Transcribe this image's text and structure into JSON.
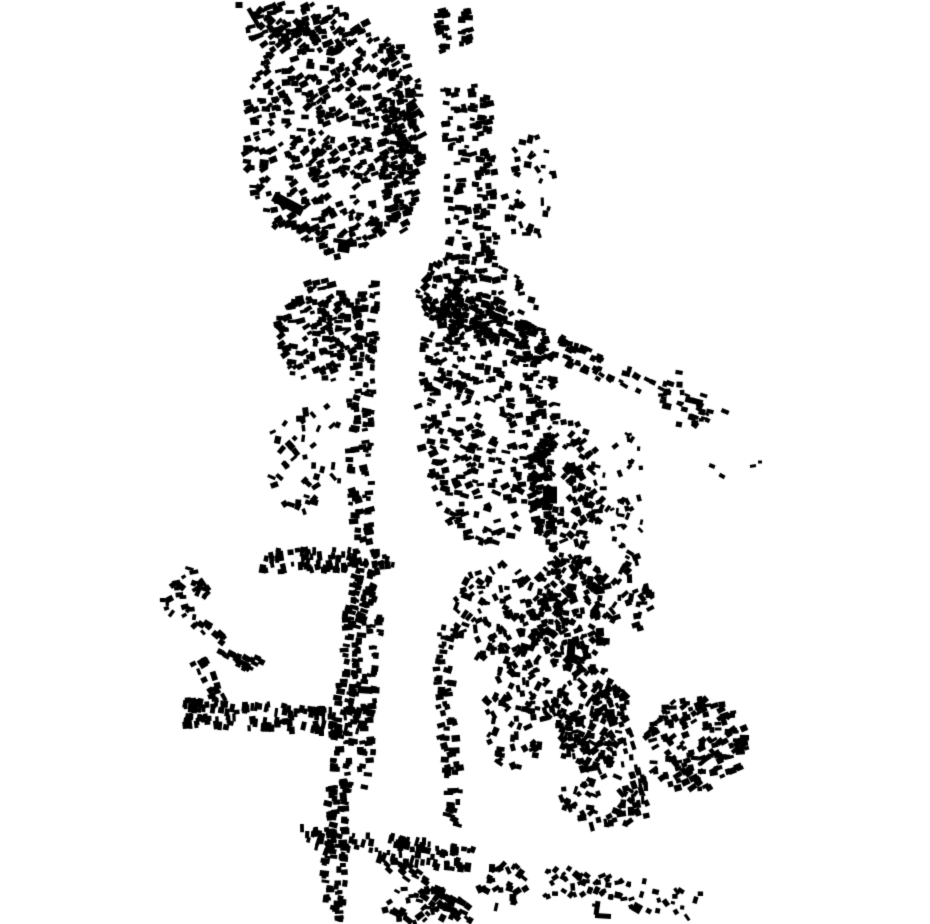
{
  "canvas": {
    "width": 930,
    "height": 924,
    "background": "#ffffff",
    "building_color": "#000000"
  },
  "map": {
    "type": "figure-ground-building-footprint-map",
    "seed": 1337,
    "density": 0.85,
    "default_size": [
      4.5,
      9.5,
      3,
      6.5
    ],
    "corridors": [
      {
        "name": "top-string-west",
        "path": [
          [
            440,
            8
          ],
          [
            446,
            52
          ]
        ],
        "half_width": 6,
        "gap": 0,
        "count": 26,
        "angle_mode": "perp",
        "jitter": 14
      },
      {
        "name": "top-string-east",
        "path": [
          [
            462,
            2
          ],
          [
            466,
            46
          ]
        ],
        "half_width": 6,
        "gap": 0,
        "count": 20,
        "angle_mode": "perp",
        "jitter": 14
      },
      {
        "name": "north-main-street",
        "path": [
          [
            467,
            85
          ],
          [
            470,
            150
          ],
          [
            472,
            215
          ],
          [
            470,
            285
          ],
          [
            467,
            335
          ]
        ],
        "half_width": 26,
        "gap": 3,
        "count": 240,
        "angle_mode": "perp",
        "jitter": 14
      },
      {
        "name": "northeast-diagonal-street",
        "path": [
          [
            415,
            298
          ],
          [
            470,
            318
          ],
          [
            527,
            337
          ],
          [
            580,
            357
          ],
          [
            636,
            382
          ]
        ],
        "half_width": 13,
        "gap": 2,
        "count": 150,
        "angle_mode": "tangent",
        "jitter": 12
      },
      {
        "name": "northeast-tail",
        "path": [
          [
            636,
            382
          ],
          [
            688,
            404
          ],
          [
            724,
            419
          ]
        ],
        "half_width": 8,
        "gap": 1,
        "count": 22,
        "angle_mode": "tangent",
        "jitter": 10,
        "size": [
          4,
          8,
          2.5,
          5
        ]
      },
      {
        "name": "west-axis-street",
        "path": [
          [
            371,
            282
          ],
          [
            366,
            340
          ],
          [
            361,
            400
          ],
          [
            359,
            455
          ],
          [
            363,
            515
          ],
          [
            369,
            565
          ]
        ],
        "half_width": 12,
        "gap": 2,
        "count": 150,
        "angle_mode": "perp",
        "jitter": 14
      },
      {
        "name": "west-south-band",
        "path": [
          [
            256,
            562
          ],
          [
            320,
            559
          ],
          [
            393,
            563
          ]
        ],
        "half_width": 11,
        "gap": 1,
        "count": 95,
        "angle_mode": "perp",
        "jitter": 14
      },
      {
        "name": "central-vertical-street",
        "path": [
          [
            531,
            338
          ],
          [
            537,
            420
          ],
          [
            542,
            495
          ],
          [
            546,
            556
          ]
        ],
        "half_width": 9,
        "gap": 1,
        "count": 85,
        "angle_mode": "perp",
        "jitter": 12
      },
      {
        "name": "southwest-branch-street",
        "path": [
          [
            182,
            712
          ],
          [
            250,
            716
          ],
          [
            320,
            720
          ],
          [
            358,
            723
          ]
        ],
        "half_width": 13,
        "gap": 2,
        "count": 150,
        "angle_mode": "perp",
        "jitter": 12
      },
      {
        "name": "hamlet-diagonal-chain",
        "path": [
          [
            195,
            624
          ],
          [
            228,
            649
          ],
          [
            259,
            668
          ]
        ],
        "half_width": 8,
        "gap": 1,
        "count": 38,
        "angle_mode": "tangent",
        "jitter": 12
      },
      {
        "name": "hamlet-south-chain",
        "path": [
          [
            199,
            661
          ],
          [
            211,
            685
          ],
          [
            220,
            704
          ]
        ],
        "half_width": 7,
        "gap": 1,
        "count": 20,
        "angle_mode": "tangent",
        "jitter": 12
      },
      {
        "name": "south-main-street",
        "path": [
          [
            367,
            570
          ],
          [
            355,
            620
          ],
          [
            347,
            690
          ],
          [
            341,
            770
          ],
          [
            336,
            850
          ],
          [
            332,
            922
          ]
        ],
        "half_width": 11,
        "gap": 2,
        "count": 250,
        "angle_mode": "perp",
        "jitter": 12
      },
      {
        "name": "south-parallel-street",
        "path": [
          [
            378,
            594
          ],
          [
            372,
            655
          ],
          [
            368,
            720
          ],
          [
            366,
            788
          ]
        ],
        "half_width": 7,
        "gap": 1,
        "count": 60,
        "angle_mode": "perp",
        "jitter": 12
      },
      {
        "name": "south-cross-band",
        "path": [
          [
            298,
            836
          ],
          [
            360,
            845
          ],
          [
            425,
            853
          ],
          [
            472,
            860
          ]
        ],
        "half_width": 12,
        "gap": 2,
        "count": 110,
        "angle_mode": "perp",
        "jitter": 12
      },
      {
        "name": "southeast-curve-street",
        "path": [
          [
            448,
            626
          ],
          [
            444,
            672
          ],
          [
            447,
            722
          ],
          [
            453,
            772
          ],
          [
            456,
            808
          ],
          [
            447,
            838
          ]
        ],
        "half_width": 8,
        "gap": 1,
        "count": 85,
        "angle_mode": "perp",
        "jitter": 12
      },
      {
        "name": "bottom-diagonal-chain",
        "path": [
          [
            388,
            858
          ],
          [
            420,
            884
          ],
          [
            452,
            906
          ],
          [
            472,
            920
          ]
        ],
        "half_width": 10,
        "gap": 1,
        "count": 55,
        "angle_mode": "tangent",
        "jitter": 14
      },
      {
        "name": "southeast-ridge-chain",
        "path": [
          [
            608,
            688
          ],
          [
            624,
            738
          ],
          [
            638,
            788
          ],
          [
            646,
            820
          ]
        ],
        "half_width": 9,
        "gap": 1,
        "count": 55,
        "angle_mode": "tangent",
        "jitter": 12
      },
      {
        "name": "bottom-edge-band",
        "path": [
          [
            540,
            880
          ],
          [
            600,
            890
          ],
          [
            658,
            899
          ],
          [
            700,
            906
          ]
        ],
        "half_width": 16,
        "gap": 0,
        "count": 75,
        "angle_mode": "random",
        "jitter": 0,
        "size": [
          4,
          8,
          3,
          5.5
        ]
      }
    ],
    "clusters": [
      {
        "name": "old-town-core",
        "cx": 332,
        "cy": 135,
        "rx": 88,
        "ry": 122,
        "count": 560,
        "angle_mode": "fixed",
        "angle": -20,
        "jitter": 30
      },
      {
        "name": "old-town-north-neck",
        "cx": 300,
        "cy": 28,
        "rx": 58,
        "ry": 26,
        "count": 110,
        "angle_mode": "fixed",
        "angle": -25,
        "jitter": 24
      },
      {
        "name": "old-town-east-column",
        "cx": 402,
        "cy": 140,
        "rx": 22,
        "ry": 95,
        "count": 130,
        "angle_mode": "fixed",
        "angle": -10,
        "jitter": 22
      },
      {
        "name": "east-scatter-north",
        "cx": 530,
        "cy": 195,
        "rx": 27,
        "ry": 60,
        "count": 40,
        "angle_mode": "random",
        "jitter": 0
      },
      {
        "name": "central-district",
        "cx": 488,
        "cy": 405,
        "rx": 72,
        "ry": 140,
        "count": 420,
        "angle_mode": "fixed",
        "angle": 0,
        "jitter": 30
      },
      {
        "name": "west-axis-upper-cluster",
        "cx": 318,
        "cy": 332,
        "rx": 42,
        "ry": 54,
        "count": 160,
        "angle_mode": "fixed",
        "angle": -15,
        "jitter": 26
      },
      {
        "name": "west-axis-mid-scatter",
        "cx": 306,
        "cy": 455,
        "rx": 40,
        "ry": 58,
        "count": 52,
        "angle_mode": "random",
        "jitter": 0
      },
      {
        "name": "east-mid-district",
        "cx": 566,
        "cy": 487,
        "rx": 38,
        "ry": 68,
        "count": 150,
        "angle_mode": "random",
        "jitter": 0
      },
      {
        "name": "east-mid-scatter",
        "cx": 625,
        "cy": 492,
        "rx": 22,
        "ry": 60,
        "count": 38,
        "angle_mode": "random",
        "jitter": 0,
        "size": [
          4,
          7.5,
          2.5,
          5
        ]
      },
      {
        "name": "ne-band-south-cluster",
        "cx": 682,
        "cy": 402,
        "rx": 24,
        "ry": 32,
        "count": 22,
        "angle_mode": "fixed",
        "angle": 15,
        "jitter": 20
      },
      {
        "name": "hamlet-west",
        "cx": 186,
        "cy": 596,
        "rx": 24,
        "ry": 30,
        "count": 34,
        "angle_mode": "random",
        "jitter": 0
      },
      {
        "name": "south-central-cluster",
        "cx": 500,
        "cy": 612,
        "rx": 48,
        "ry": 50,
        "count": 115,
        "angle_mode": "random",
        "jitter": 0
      },
      {
        "name": "mid-south-bridge",
        "cx": 516,
        "cy": 706,
        "rx": 34,
        "ry": 68,
        "count": 100,
        "angle_mode": "random",
        "jitter": 0
      },
      {
        "name": "se-mass-north",
        "cx": 570,
        "cy": 610,
        "rx": 44,
        "ry": 58,
        "count": 230,
        "angle_mode": "random",
        "jitter": 0
      },
      {
        "name": "se-mass-mid",
        "cx": 590,
        "cy": 718,
        "rx": 40,
        "ry": 54,
        "count": 200,
        "angle_mode": "random",
        "jitter": 0
      },
      {
        "name": "se-mass-south-scatter",
        "cx": 600,
        "cy": 802,
        "rx": 44,
        "ry": 28,
        "count": 55,
        "angle_mode": "random",
        "jitter": 0
      },
      {
        "name": "east-satellite",
        "cx": 696,
        "cy": 744,
        "rx": 52,
        "ry": 47,
        "count": 190,
        "angle_mode": "fixed",
        "angle": -20,
        "jitter": 24
      },
      {
        "name": "bottom-right-scatter",
        "cx": 505,
        "cy": 886,
        "rx": 26,
        "ry": 24,
        "count": 32,
        "angle_mode": "random",
        "jitter": 0
      },
      {
        "name": "bottom-center-edge",
        "cx": 420,
        "cy": 905,
        "rx": 38,
        "ry": 18,
        "count": 45,
        "angle_mode": "random",
        "jitter": 0
      },
      {
        "name": "river-east-neck",
        "cx": 448,
        "cy": 300,
        "rx": 26,
        "ry": 45,
        "count": 70,
        "angle_mode": "random",
        "jitter": 0
      },
      {
        "name": "se-east-scatter",
        "cx": 632,
        "cy": 592,
        "rx": 20,
        "ry": 42,
        "count": 40,
        "angle_mode": "random",
        "jitter": 0
      }
    ],
    "landmarks": [
      {
        "name": "nw-corner-square",
        "cx": 239,
        "cy": 5,
        "w": 7,
        "h": 6,
        "angle": 0
      },
      {
        "name": "long-wall-northwest",
        "cx": 254,
        "cy": 18,
        "w": 22,
        "h": 4.5,
        "angle": 60
      },
      {
        "name": "large-hall-west",
        "cx": 288,
        "cy": 204,
        "w": 33,
        "h": 10,
        "angle": 28
      },
      {
        "name": "square-block-west",
        "cx": 264,
        "cy": 164,
        "w": 9,
        "h": 9,
        "angle": 5
      },
      {
        "name": "dark-block-oldtown",
        "cx": 344,
        "cy": 246,
        "w": 12,
        "h": 13,
        "angle": 8
      },
      {
        "name": "large-block-central",
        "cx": 550,
        "cy": 495,
        "w": 14,
        "h": 17,
        "angle": 0
      },
      {
        "name": "long-bar-northeast",
        "cx": 694,
        "cy": 401,
        "w": 18,
        "h": 6,
        "angle": 14
      },
      {
        "name": "dot-east-1",
        "cx": 712,
        "cy": 466,
        "w": 6,
        "h": 4,
        "angle": 20
      },
      {
        "name": "dot-east-2",
        "cx": 722,
        "cy": 476,
        "w": 6,
        "h": 4,
        "angle": 28
      },
      {
        "name": "dot-east-3",
        "cx": 753,
        "cy": 466,
        "w": 6,
        "h": 3,
        "angle": -8
      },
      {
        "name": "dot-east-4",
        "cx": 760,
        "cy": 462,
        "w": 4,
        "h": 3,
        "angle": 0
      },
      {
        "name": "wide-bar-southwest",
        "cx": 365,
        "cy": 690,
        "w": 15,
        "h": 7,
        "angle": 3
      },
      {
        "name": "tall-bar-southeast",
        "cx": 571,
        "cy": 651,
        "w": 8,
        "h": 24,
        "angle": 4
      },
      {
        "name": "l-building-bottom-a",
        "cx": 597,
        "cy": 908,
        "w": 5,
        "h": 14,
        "angle": 8
      },
      {
        "name": "l-building-bottom-b",
        "cx": 603,
        "cy": 916,
        "w": 16,
        "h": 5,
        "angle": 3
      },
      {
        "name": "rotated-square-bottom",
        "cx": 637,
        "cy": 908,
        "w": 9,
        "h": 9,
        "angle": 30
      }
    ]
  }
}
